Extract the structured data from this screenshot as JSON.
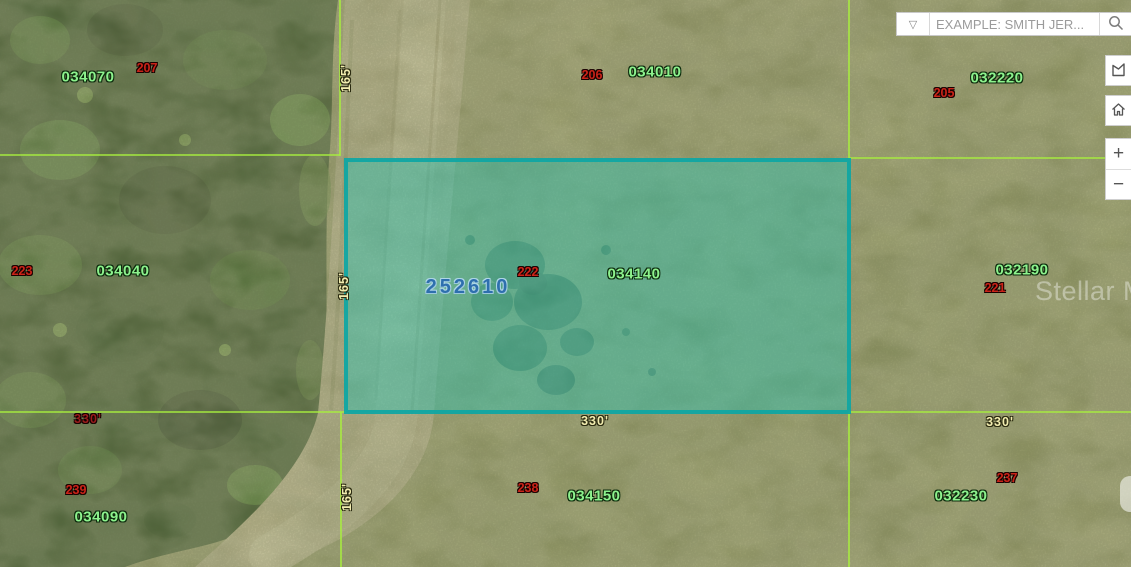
{
  "search": {
    "placeholder": "EXAMPLE: SMITH JER...",
    "dropdown_glyph": "▽"
  },
  "controls": {
    "zoom_in_glyph": "+",
    "zoom_out_glyph": "−"
  },
  "map": {
    "selected_parcel": {
      "id": "252610"
    },
    "parcel_numbers": [
      "034070",
      "034010",
      "032220",
      "034040",
      "034140",
      "032190",
      "034150",
      "032230",
      "034090"
    ],
    "lot_numbers": [
      "207",
      "206",
      "205",
      "223",
      "222",
      "221",
      "239",
      "238",
      "237"
    ],
    "dimensions": {
      "left_330": "330'",
      "mid_330": "330'",
      "right_330": "330'",
      "top_165": "165'",
      "mid_165": "165'",
      "bottom_165": "165'"
    },
    "watermark": "Stellar MLS",
    "colors": {
      "boundary_line": "#a8ef3e",
      "selected_fill": "#24c6b4",
      "selected_border": "#0da6a4",
      "parcel_number_text": "#8df28d",
      "lot_number_text": "#cb2318",
      "selected_id_text": "#2e6fae",
      "dimension_text": "#f2edb0",
      "dimension_text_dark": "#9b1c1c"
    }
  }
}
